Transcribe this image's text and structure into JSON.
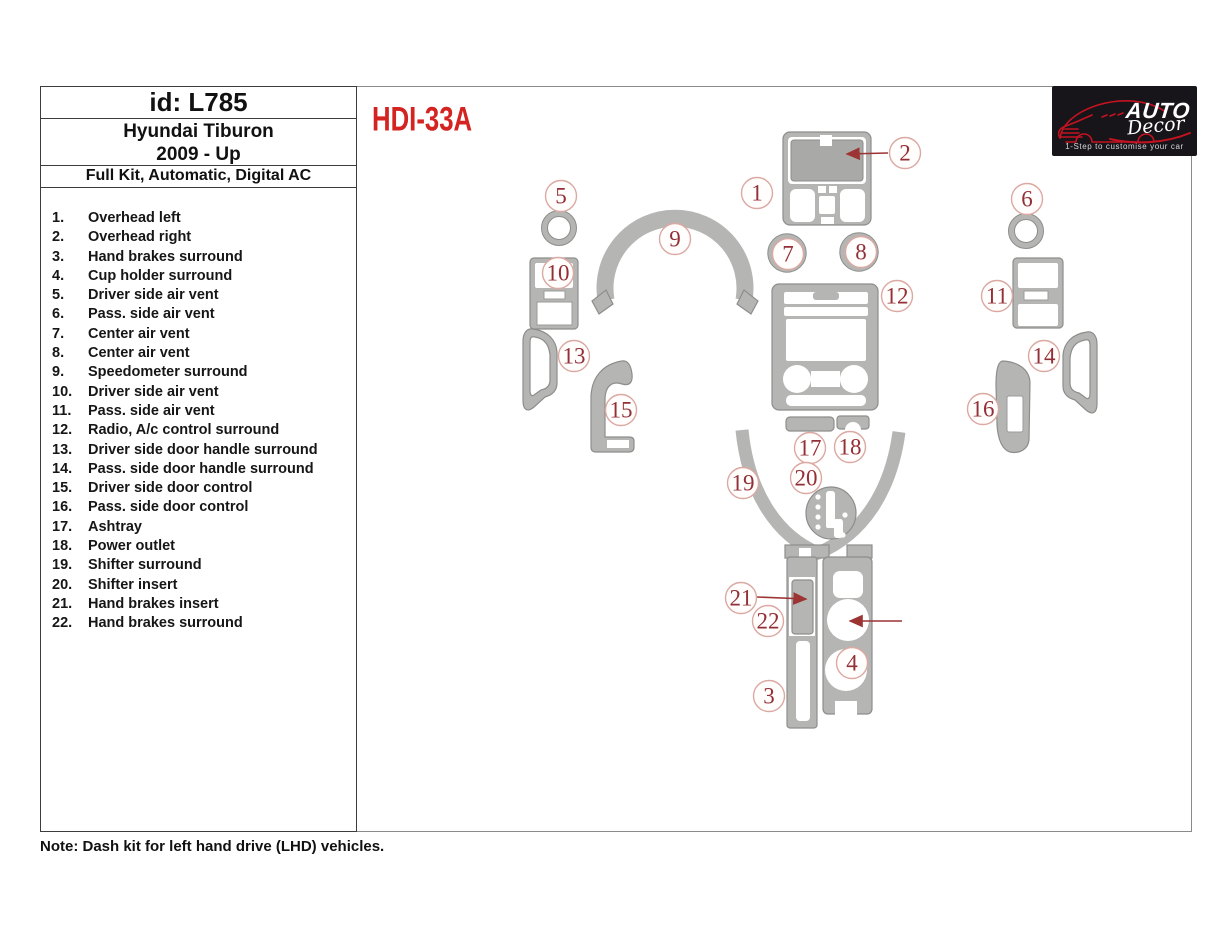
{
  "header": {
    "id": "id: L785",
    "vehicle": "Hyundai Tiburon",
    "years": "2009 - Up",
    "kit": "Full Kit, Automatic, Digital AC"
  },
  "kit_code": "HDI-33A",
  "note": "Note: Dash kit for left hand drive (LHD)  vehicles.",
  "logo": {
    "brand_top": "AUTO",
    "brand_bottom": "Decor",
    "tagline": "1-Step to customise your car"
  },
  "parts": [
    {
      "num": "1.",
      "label": "Overhead left"
    },
    {
      "num": "2.",
      "label": "Overhead right"
    },
    {
      "num": "3.",
      "label": "Hand brakes surround"
    },
    {
      "num": "4.",
      "label": "Cup holder surround"
    },
    {
      "num": "5.",
      "label": "Driver side air vent"
    },
    {
      "num": "6.",
      "label": "Pass. side air vent"
    },
    {
      "num": "7.",
      "label": "Center air vent"
    },
    {
      "num": "8.",
      "label": "Center air vent"
    },
    {
      "num": "9.",
      "label": "Speedometer surround"
    },
    {
      "num": "10.",
      "label": "Driver side air vent"
    },
    {
      "num": "11.",
      "label": "Pass. side air vent"
    },
    {
      "num": "12.",
      "label": "Radio, A/c control surround"
    },
    {
      "num": "13.",
      "label": "Driver side door handle surround"
    },
    {
      "num": "14.",
      "label": "Pass. side door handle surround"
    },
    {
      "num": "15.",
      "label": "Driver side door control"
    },
    {
      "num": "16.",
      "label": "Pass. side door control"
    },
    {
      "num": "17.",
      "label": "Ashtray"
    },
    {
      "num": "18.",
      "label": "Power outlet"
    },
    {
      "num": "19.",
      "label": "Shifter surround"
    },
    {
      "num": "20.",
      "label": "Shifter insert"
    },
    {
      "num": "21.",
      "label": "Hand brakes insert"
    },
    {
      "num": "22.",
      "label": "Hand brakes surround"
    }
  ],
  "diagram": {
    "callouts": [
      {
        "n": "1",
        "x": 757,
        "y": 193
      },
      {
        "n": "2",
        "x": 905,
        "y": 153
      },
      {
        "n": "3",
        "x": 769,
        "y": 696
      },
      {
        "n": "4",
        "x": 852,
        "y": 663
      },
      {
        "n": "5",
        "x": 561,
        "y": 196
      },
      {
        "n": "6",
        "x": 1027,
        "y": 199
      },
      {
        "n": "7",
        "x": 788,
        "y": 254
      },
      {
        "n": "8",
        "x": 861,
        "y": 252
      },
      {
        "n": "9",
        "x": 675,
        "y": 239
      },
      {
        "n": "10",
        "x": 558,
        "y": 273
      },
      {
        "n": "11",
        "x": 997,
        "y": 296
      },
      {
        "n": "12",
        "x": 897,
        "y": 296
      },
      {
        "n": "13",
        "x": 574,
        "y": 356
      },
      {
        "n": "14",
        "x": 1044,
        "y": 356
      },
      {
        "n": "15",
        "x": 621,
        "y": 410
      },
      {
        "n": "16",
        "x": 983,
        "y": 409
      },
      {
        "n": "17",
        "x": 810,
        "y": 448
      },
      {
        "n": "18",
        "x": 850,
        "y": 447
      },
      {
        "n": "19",
        "x": 743,
        "y": 483
      },
      {
        "n": "20",
        "x": 806,
        "y": 478
      },
      {
        "n": "21",
        "x": 741,
        "y": 598
      },
      {
        "n": "22",
        "x": 768,
        "y": 621
      }
    ],
    "arrows": [
      {
        "x1": 888,
        "y1": 153,
        "x2": 847,
        "y2": 154
      },
      {
        "x1": 757,
        "y1": 597,
        "x2": 806,
        "y2": 599
      },
      {
        "x1": 902,
        "y1": 621,
        "x2": 850,
        "y2": 621
      }
    ]
  },
  "colors": {
    "accent_red": "#d42421",
    "callout_red": "#932f36",
    "arrow_red": "#9c3434",
    "part_gray": "#b5b6b4",
    "part_outline": "#8d8e8c",
    "logo_bg": "#17141a",
    "logo_car_red": "#c41320"
  }
}
